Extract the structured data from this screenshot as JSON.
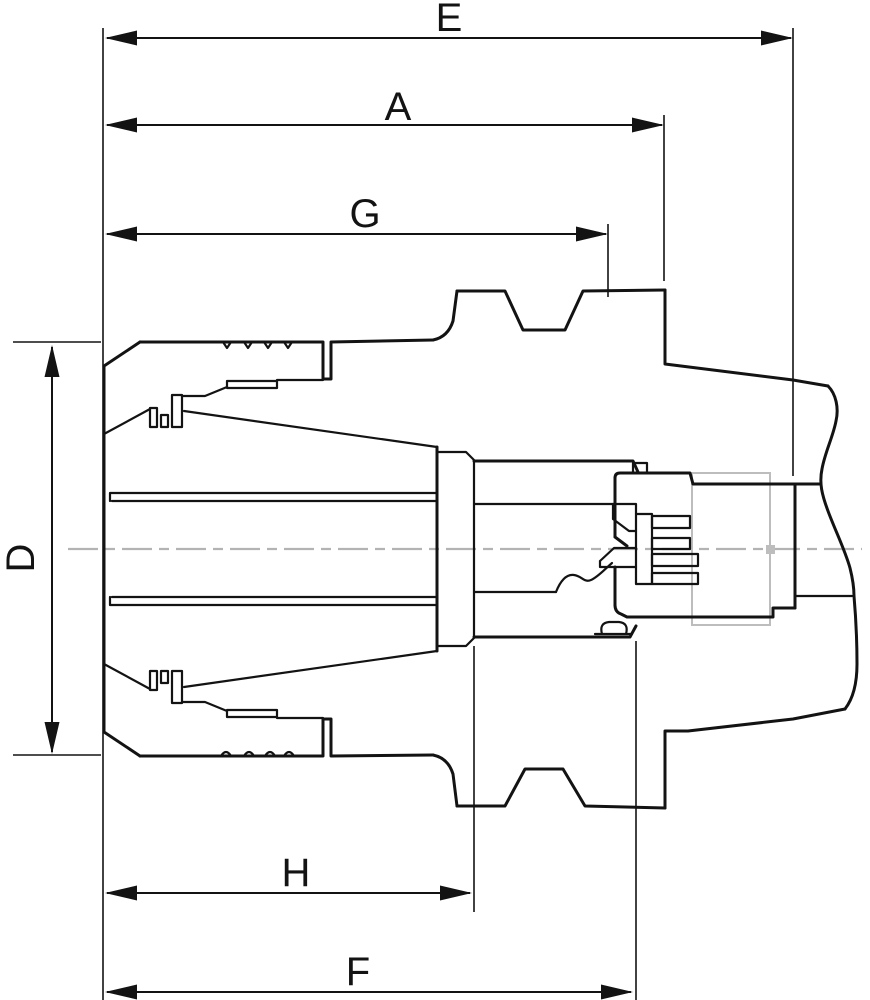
{
  "figure": {
    "kind": "engineering-cross-section-drawing",
    "subject": "collet chuck tool holder cross-section with dimension callouts",
    "colors": {
      "bg": "#ffffff",
      "ink": "#131313",
      "centerline": "#b3b3b3",
      "phantom": "#bdbdbd"
    }
  },
  "dims": {
    "E": {
      "label": "E",
      "orientation": "horizontal"
    },
    "A": {
      "label": "A",
      "orientation": "horizontal"
    },
    "G": {
      "label": "G",
      "orientation": "horizontal"
    },
    "D": {
      "label": "D",
      "orientation": "vertical"
    },
    "H": {
      "label": "H",
      "orientation": "horizontal"
    },
    "F": {
      "label": "F",
      "orientation": "horizontal"
    }
  }
}
